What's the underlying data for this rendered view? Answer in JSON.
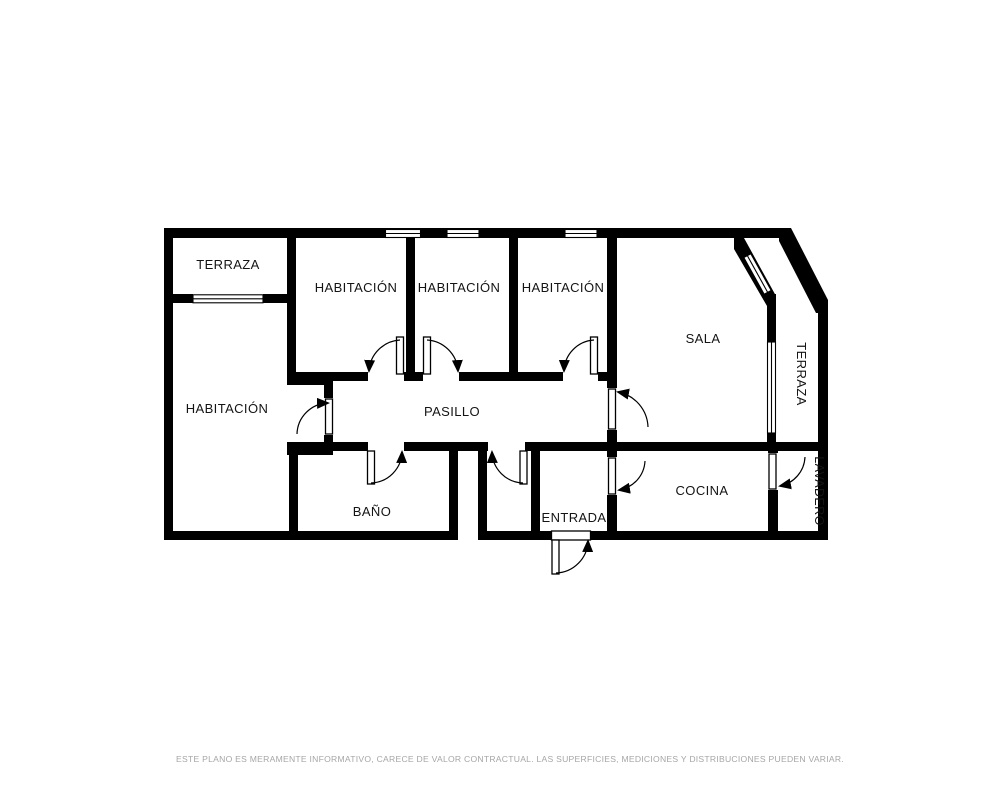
{
  "colors": {
    "background": "#ffffff",
    "wall": "#000000",
    "room_fill": "#ffffff",
    "door_line": "#1a1a1a",
    "disclaimer": "#a6a6a6"
  },
  "rooms": {
    "terraza_top_left": {
      "label": "TERRAZA"
    },
    "habitacion_left": {
      "label": "HABITACIÓN"
    },
    "habitacion_1": {
      "label": "HABITACIÓN"
    },
    "habitacion_2": {
      "label": "HABITACIÓN"
    },
    "habitacion_3": {
      "label": "HABITACIÓN"
    },
    "pasillo": {
      "label": "PASILLO"
    },
    "sala": {
      "label": "SALA"
    },
    "bano": {
      "label": "BAÑO"
    },
    "entrada": {
      "label": "ENTRADA"
    },
    "cocina": {
      "label": "COCINA"
    },
    "lavadero": {
      "label": "LAVADERO"
    },
    "terraza_right": {
      "label": "TERRAZA"
    }
  },
  "footer": {
    "disclaimer": "ESTE PLANO ES MERAMENTE INFORMATIVO, CARECE DE VALOR CONTRACTUAL. LAS SUPERFICIES, MEDICIONES Y DISTRIBUCIONES PUEDEN VARIAR."
  }
}
